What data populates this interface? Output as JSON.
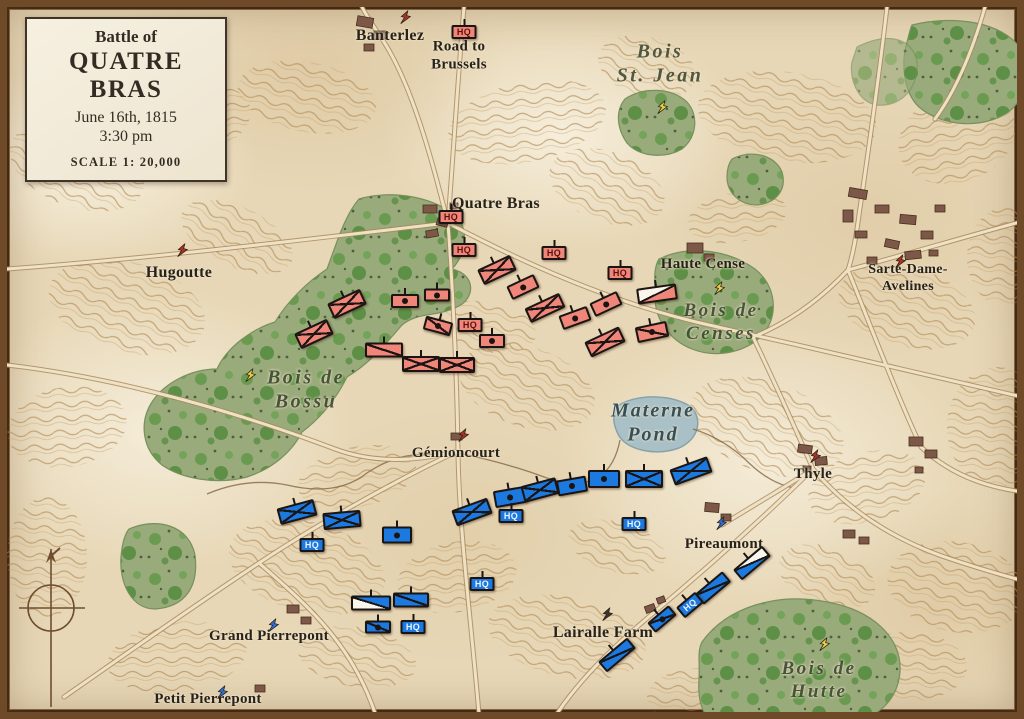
{
  "title_box": {
    "pretitle": "Battle of",
    "title": "QUATRE BRAS",
    "date": "June 16th, 1815",
    "time": "3:30 pm",
    "scale": "SCALE   1: 20,000"
  },
  "map": {
    "hq_label": "HQ",
    "unit_colors": {
      "red": "#ef8679",
      "blue": "#1b79e0"
    },
    "labels": [
      {
        "text": "Banterlez",
        "x": 383,
        "y": 29,
        "cls": "place",
        "size": 16
      },
      {
        "text": "Road to\nBrussels",
        "x": 452,
        "y": 49,
        "cls": "place",
        "size": 15
      },
      {
        "text": "Bois\nSt. Jean",
        "x": 653,
        "y": 57,
        "cls": "wood",
        "size": 20
      },
      {
        "text": "Quatre Bras",
        "x": 489,
        "y": 197,
        "cls": "place",
        "size": 16
      },
      {
        "text": "Haute Cense",
        "x": 696,
        "y": 257,
        "cls": "place",
        "size": 15
      },
      {
        "text": "Sarte-Dame-Avelines",
        "x": 901,
        "y": 271,
        "cls": "place",
        "size": 14
      },
      {
        "text": "Hugoutte",
        "x": 172,
        "y": 266,
        "cls": "place",
        "size": 16
      },
      {
        "text": "Bois de\nCenses",
        "x": 714,
        "y": 315,
        "cls": "wood",
        "size": 19
      },
      {
        "text": "Bois de\nBossu",
        "x": 299,
        "y": 383,
        "cls": "wood",
        "size": 20
      },
      {
        "text": "Materne\nPond",
        "x": 646,
        "y": 416,
        "cls": "water",
        "size": 20
      },
      {
        "text": "Gémioncourt",
        "x": 449,
        "y": 446,
        "cls": "place",
        "size": 15
      },
      {
        "text": "Thyle",
        "x": 806,
        "y": 467,
        "cls": "place",
        "size": 15
      },
      {
        "text": "Pireaumont",
        "x": 717,
        "y": 537,
        "cls": "place",
        "size": 15
      },
      {
        "text": "Grand Pierrepont",
        "x": 262,
        "y": 629,
        "cls": "place",
        "size": 15
      },
      {
        "text": "Lairalle Farm",
        "x": 596,
        "y": 626,
        "cls": "place",
        "size": 16
      },
      {
        "text": "Petit Pierrepont",
        "x": 201,
        "y": 692,
        "cls": "place",
        "size": 15
      },
      {
        "text": "Bois de\nHutte",
        "x": 812,
        "y": 673,
        "cls": "wood",
        "size": 19
      }
    ],
    "units": [
      {
        "side": "red",
        "type": "hq",
        "x": 457,
        "y": 25
      },
      {
        "side": "red",
        "type": "hq",
        "x": 444,
        "y": 210
      },
      {
        "side": "red",
        "type": "hq",
        "x": 457,
        "y": 243
      },
      {
        "side": "red",
        "type": "hq",
        "x": 547,
        "y": 246
      },
      {
        "side": "red",
        "type": "hq",
        "x": 613,
        "y": 266
      },
      {
        "side": "red",
        "type": "hq",
        "x": 463,
        "y": 318
      },
      {
        "side": "red",
        "type": "inf",
        "x": 340,
        "y": 297,
        "rot": -25
      },
      {
        "side": "red",
        "type": "inf",
        "x": 307,
        "y": 327,
        "rot": -25
      },
      {
        "side": "red",
        "type": "cav",
        "x": 377,
        "y": 343,
        "w": 38,
        "h": 15
      },
      {
        "side": "red",
        "type": "inf",
        "x": 414,
        "y": 357,
        "w": 38,
        "h": 16
      },
      {
        "side": "red",
        "type": "inf",
        "x": 450,
        "y": 358,
        "w": 36,
        "h": 16
      },
      {
        "side": "red",
        "type": "art",
        "x": 398,
        "y": 294,
        "w": 28,
        "h": 14
      },
      {
        "side": "red",
        "type": "art",
        "x": 430,
        "y": 288,
        "w": 26,
        "h": 13
      },
      {
        "side": "red",
        "type": "cavdot",
        "x": 431,
        "y": 319,
        "rot": 15,
        "w": 28,
        "h": 14
      },
      {
        "side": "red",
        "type": "art",
        "x": 485,
        "y": 334,
        "w": 26,
        "h": 14
      },
      {
        "side": "red",
        "type": "inf",
        "x": 490,
        "y": 263,
        "rot": -25
      },
      {
        "side": "red",
        "type": "art",
        "x": 516,
        "y": 280,
        "rot": -25,
        "w": 30,
        "h": 15
      },
      {
        "side": "red",
        "type": "inf",
        "x": 538,
        "y": 301,
        "rot": -25,
        "w": 38,
        "h": 16
      },
      {
        "side": "red",
        "type": "art",
        "x": 568,
        "y": 311,
        "rot": -20,
        "w": 30,
        "h": 15
      },
      {
        "side": "red",
        "type": "art",
        "x": 599,
        "y": 297,
        "rot": -25,
        "w": 30,
        "h": 15
      },
      {
        "side": "red",
        "type": "inf",
        "x": 598,
        "y": 335,
        "rot": -25,
        "w": 38,
        "h": 17
      },
      {
        "side": "red",
        "type": "cavdot",
        "x": 645,
        "y": 325,
        "rot": -12,
        "w": 32,
        "h": 16
      },
      {
        "side": "red",
        "type": "cavw",
        "x": 650,
        "y": 287,
        "rot": -8,
        "white": "tl",
        "w": 40,
        "h": 16
      },
      {
        "side": "blue",
        "type": "inf",
        "x": 290,
        "y": 505,
        "rot": -15,
        "w": 38,
        "h": 17
      },
      {
        "side": "blue",
        "type": "inf",
        "x": 335,
        "y": 513,
        "rot": -5,
        "w": 38,
        "h": 17
      },
      {
        "side": "blue",
        "type": "hq",
        "x": 305,
        "y": 538
      },
      {
        "side": "blue",
        "type": "art",
        "x": 390,
        "y": 528,
        "w": 30,
        "h": 17
      },
      {
        "side": "blue",
        "type": "inf",
        "x": 465,
        "y": 505,
        "rot": -20,
        "w": 38,
        "h": 17
      },
      {
        "side": "blue",
        "type": "art",
        "x": 503,
        "y": 490,
        "rot": -10,
        "w": 32,
        "h": 17
      },
      {
        "side": "blue",
        "type": "inf",
        "x": 533,
        "y": 483,
        "rot": -15,
        "w": 36,
        "h": 17
      },
      {
        "side": "blue",
        "type": "art",
        "x": 565,
        "y": 479,
        "rot": -10,
        "w": 30,
        "h": 16
      },
      {
        "side": "blue",
        "type": "hq",
        "x": 504,
        "y": 509
      },
      {
        "side": "blue",
        "type": "art",
        "x": 597,
        "y": 472,
        "w": 32,
        "h": 18
      },
      {
        "side": "blue",
        "type": "inf",
        "x": 637,
        "y": 472,
        "w": 38,
        "h": 18
      },
      {
        "side": "blue",
        "type": "inf",
        "x": 684,
        "y": 464,
        "rot": -20,
        "w": 40,
        "h": 17
      },
      {
        "side": "blue",
        "type": "hq",
        "x": 627,
        "y": 517
      },
      {
        "side": "blue",
        "type": "cavw",
        "x": 364,
        "y": 596,
        "white": "bl",
        "w": 40,
        "h": 15
      },
      {
        "side": "blue",
        "type": "cav",
        "x": 404,
        "y": 593,
        "w": 36,
        "h": 15
      },
      {
        "side": "blue",
        "type": "cavdot",
        "x": 371,
        "y": 620,
        "w": 26,
        "h": 13
      },
      {
        "side": "blue",
        "type": "hq",
        "x": 406,
        "y": 620
      },
      {
        "side": "blue",
        "type": "hq",
        "x": 475,
        "y": 577
      },
      {
        "side": "blue",
        "type": "cavw",
        "x": 745,
        "y": 556,
        "rot": -40,
        "white": "tr",
        "w": 38,
        "h": 14
      },
      {
        "side": "blue",
        "type": "cav",
        "x": 706,
        "y": 581,
        "rot": -40,
        "w": 36,
        "h": 14
      },
      {
        "side": "blue",
        "type": "hq",
        "x": 683,
        "y": 598,
        "rot": -40
      },
      {
        "side": "blue",
        "type": "cavdot",
        "x": 655,
        "y": 612,
        "rot": -40,
        "w": 28,
        "h": 13
      },
      {
        "side": "blue",
        "type": "cav",
        "x": 610,
        "y": 648,
        "rot": -40,
        "w": 38,
        "h": 14
      }
    ],
    "markers": [
      {
        "x": 655,
        "y": 103,
        "color": "#e4cf45"
      },
      {
        "x": 243,
        "y": 371,
        "color": "#e4cf45"
      },
      {
        "x": 712,
        "y": 284,
        "color": "#e4cf45"
      },
      {
        "x": 817,
        "y": 640,
        "color": "#e4cf45"
      },
      {
        "x": 175,
        "y": 246,
        "color": "#a83326"
      },
      {
        "x": 398,
        "y": 13,
        "color": "#a83326"
      },
      {
        "x": 808,
        "y": 452,
        "color": "#a83326"
      },
      {
        "x": 893,
        "y": 257,
        "color": "#a83326"
      },
      {
        "x": 456,
        "y": 431,
        "color": "#a83326"
      },
      {
        "x": 600,
        "y": 610,
        "color": "#3c3631"
      },
      {
        "x": 714,
        "y": 519,
        "color": "#2b6fd4"
      },
      {
        "x": 266,
        "y": 621,
        "color": "#2b6fd4"
      },
      {
        "x": 215,
        "y": 688,
        "color": "#2b6fd4"
      }
    ]
  }
}
